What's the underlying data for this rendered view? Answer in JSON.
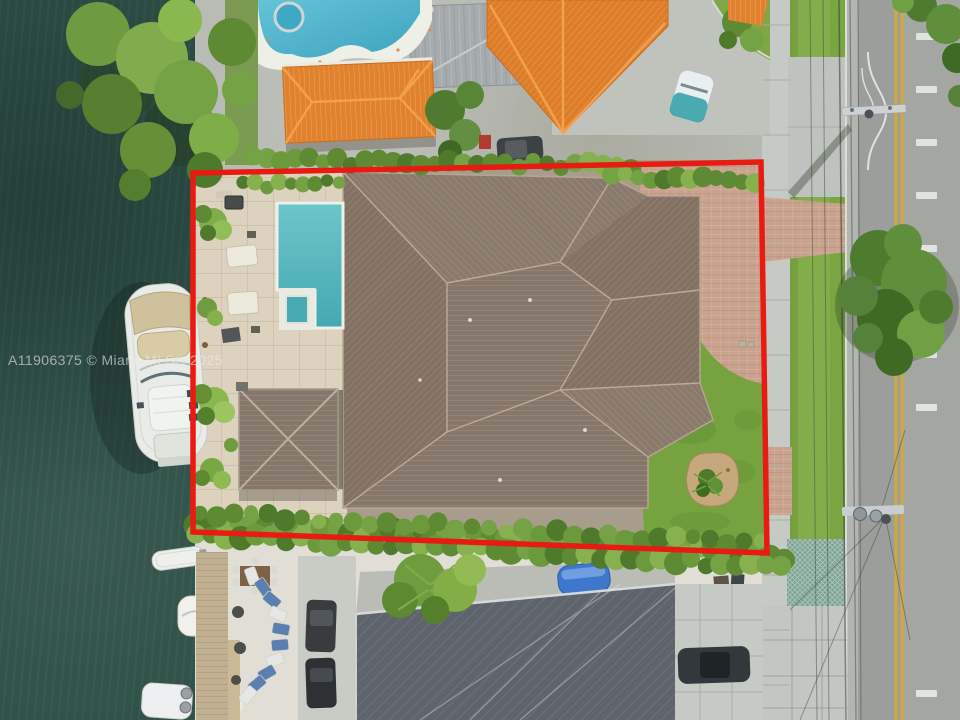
{
  "image_type": "aerial drone real-estate photograph, top-down view of waterfront property",
  "watermark": {
    "text": "A11906375 © Miami MLS® 2025"
  },
  "highlight": {
    "label": "property boundary outline",
    "color": "#e81b12"
  },
  "palette": {
    "boundary_red": "#e81b12",
    "water": "#2e5047",
    "grass_lawn": "#76a23f",
    "hedge_green": "#5d8a33",
    "roof_brown": "#87766a",
    "roof_orange": "#e0812d",
    "roof_gray": "#5d646b",
    "pool_teal": "#52b7bd",
    "neighbor_pool": "#49b2c8",
    "travertine": "#dcd2be",
    "pavers": "#c9a28e",
    "concrete": "#b7bbb3",
    "sidewalk": "#c6cac4",
    "road": "#9c9f9b",
    "yellow_line": "#d2a93a",
    "boat_white": "#e9ebe6",
    "canvas_tan": "#cfc19b"
  }
}
